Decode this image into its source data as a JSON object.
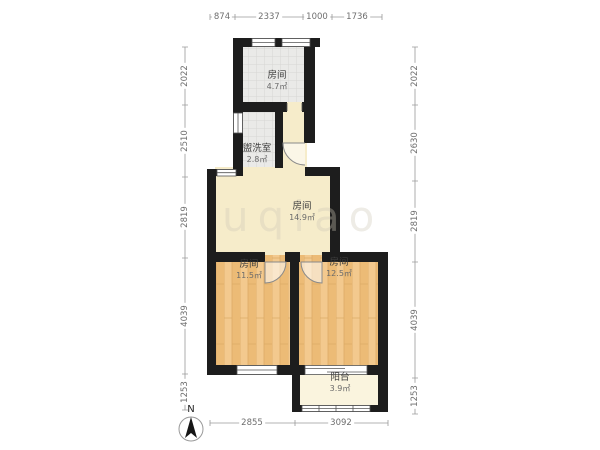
{
  "watermark": "uqiao",
  "compass": {
    "label": "N"
  },
  "rooms": [
    {
      "id": "room-top",
      "name": "房间",
      "area": "4.7㎡"
    },
    {
      "id": "washroom",
      "name": "盥洗室",
      "area": "2.8㎡"
    },
    {
      "id": "hall",
      "name": "房间",
      "area": "14.9㎡"
    },
    {
      "id": "bedroom-left",
      "name": "房间",
      "area": "11.5㎡"
    },
    {
      "id": "bedroom-right",
      "name": "房间",
      "area": "12.5㎡"
    },
    {
      "id": "balcony",
      "name": "阳台",
      "area": "3.9㎡"
    }
  ],
  "dimensions": {
    "top": [
      "874",
      "2337",
      "1000",
      "1736"
    ],
    "bottom": [
      "2855",
      "3092"
    ],
    "left": [
      "2022",
      "2510",
      "2819",
      "4039",
      "1253"
    ],
    "right": [
      "2022",
      "2630",
      "2819",
      "4039",
      "1253"
    ]
  },
  "colors": {
    "wall": "#1d1d1d",
    "hall_floor": "#f6ecca",
    "wood_floor": "#f3c98e",
    "tile_floor": "#eaeae8",
    "balcony_floor": "#faf4de",
    "dim_text": "#6e6e6e"
  }
}
